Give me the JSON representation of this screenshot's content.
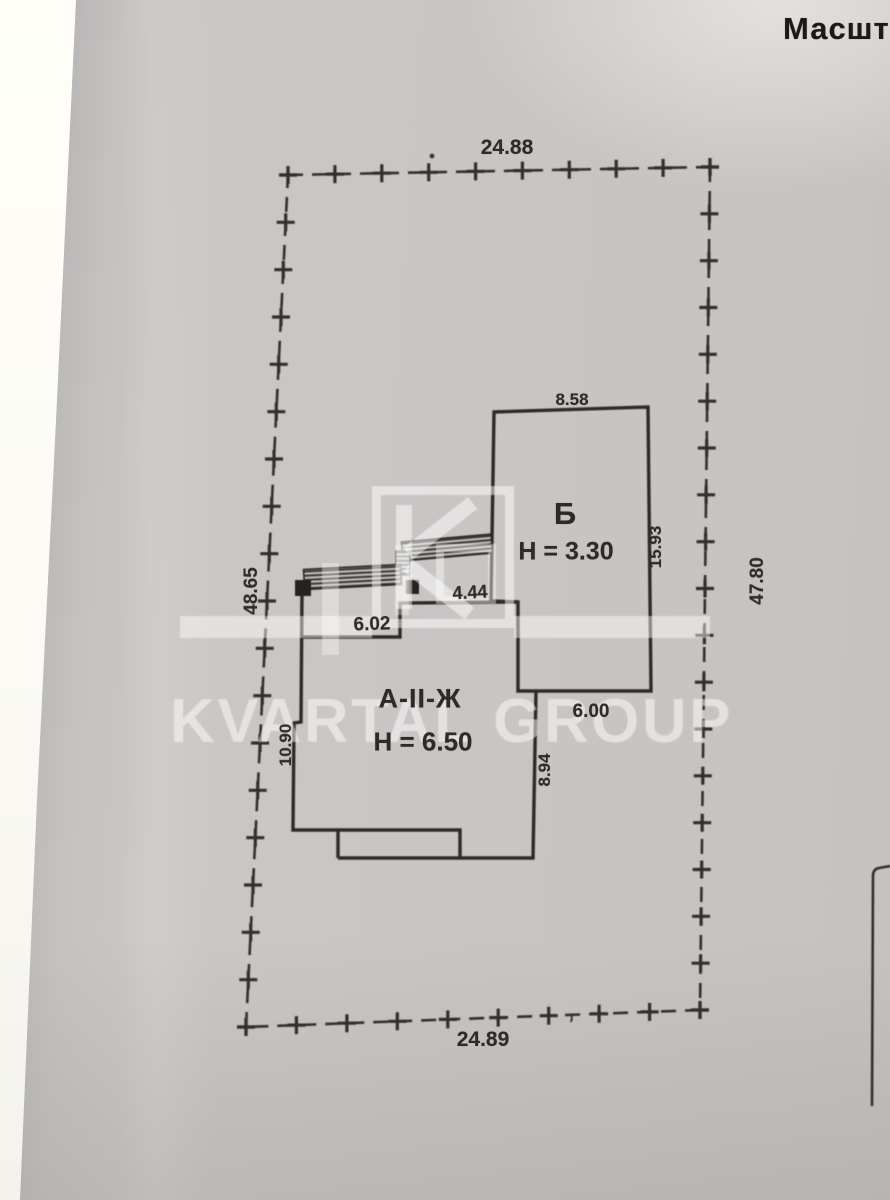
{
  "header": {
    "scale_label": "Масшта"
  },
  "watermark": {
    "text": "KVARTAL GROUP"
  },
  "site_boundary": {
    "dim_top": "24.88",
    "dim_bottom": "24.89",
    "dim_left": "48.65",
    "dim_right": "47.80"
  },
  "building_b": {
    "label": "Б",
    "height": "Н = 3.30",
    "dim_top": "8.58",
    "dim_right": "15.93",
    "dim_bottom": "6.00"
  },
  "building_a": {
    "label": "А-II-Ж",
    "height": "Н = 6.50",
    "dim_top_left": "6.02",
    "dim_top_inner": "4.44",
    "dim_left": "10.90",
    "dim_right": "8.94"
  },
  "colors": {
    "paper": "#c8c5c3",
    "ink": "#2e2a25",
    "watermark": "#ffffff"
  }
}
